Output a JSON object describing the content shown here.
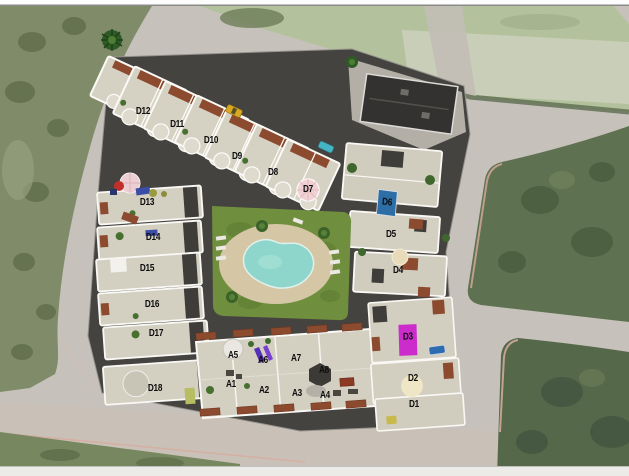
{
  "colors": {
    "road": "#c6c2bb",
    "pool_water": "#8ed6cb",
    "lawn_green": "#6f8e3e",
    "building_roof": "#d3cfc1",
    "pergola_terracotta": "#8c4a2e",
    "highlight_blue": "#2e6ea6",
    "highlight_magenta": "#cb2ccb",
    "label_text": "#0d0d0d"
  },
  "site_plan": {
    "unit_labels": [
      {
        "id": "d12",
        "label": "D12",
        "x": 143,
        "y": 112
      },
      {
        "id": "d11",
        "label": "D11",
        "x": 177,
        "y": 125
      },
      {
        "id": "d10",
        "label": "D10",
        "x": 211,
        "y": 141
      },
      {
        "id": "d9",
        "label": "D9",
        "x": 237,
        "y": 157
      },
      {
        "id": "d8",
        "label": "D8",
        "x": 273,
        "y": 173
      },
      {
        "id": "d7",
        "label": "D7",
        "x": 308,
        "y": 190
      },
      {
        "id": "d13",
        "label": "D13",
        "x": 147,
        "y": 203
      },
      {
        "id": "d14",
        "label": "D14",
        "x": 153,
        "y": 238
      },
      {
        "id": "d15",
        "label": "D15",
        "x": 147,
        "y": 269
      },
      {
        "id": "d16",
        "label": "D16",
        "x": 152,
        "y": 305
      },
      {
        "id": "d17",
        "label": "D17",
        "x": 156,
        "y": 334
      },
      {
        "id": "d18",
        "label": "D18",
        "x": 155,
        "y": 389
      },
      {
        "id": "d6",
        "label": "D6",
        "x": 387,
        "y": 203,
        "highlight": "blue"
      },
      {
        "id": "d5",
        "label": "D5",
        "x": 391,
        "y": 235
      },
      {
        "id": "d4",
        "label": "D4",
        "x": 398,
        "y": 271
      },
      {
        "id": "d3",
        "label": "D3",
        "x": 408,
        "y": 340,
        "highlight": "magenta"
      },
      {
        "id": "d2",
        "label": "D2",
        "x": 413,
        "y": 379
      },
      {
        "id": "d1",
        "label": "D1",
        "x": 414,
        "y": 405
      },
      {
        "id": "a5",
        "label": "A5",
        "x": 233,
        "y": 356
      },
      {
        "id": "a6",
        "label": "A6",
        "x": 263,
        "y": 361
      },
      {
        "id": "a7",
        "label": "A7",
        "x": 296,
        "y": 359
      },
      {
        "id": "a8",
        "label": "A8",
        "x": 324,
        "y": 371
      },
      {
        "id": "a1",
        "label": "A1",
        "x": 231,
        "y": 385
      },
      {
        "id": "a2",
        "label": "A2",
        "x": 264,
        "y": 391
      },
      {
        "id": "a3",
        "label": "A3",
        "x": 297,
        "y": 394
      },
      {
        "id": "a4",
        "label": "A4",
        "x": 325,
        "y": 396
      }
    ]
  }
}
